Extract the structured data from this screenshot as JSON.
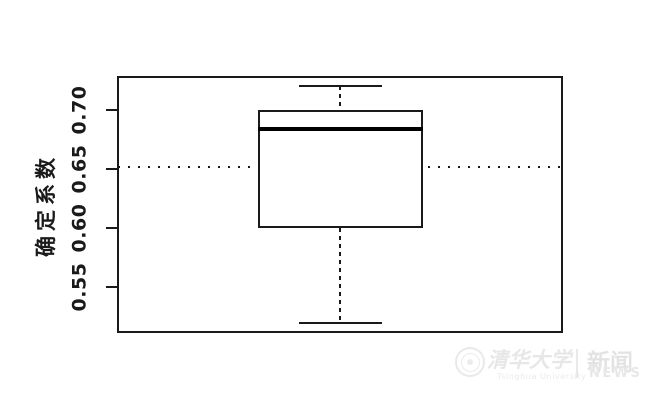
{
  "chart_data": {
    "type": "boxplot",
    "title": "",
    "xlabel": "",
    "ylabel": "确定系数",
    "ylim": [
      0.512,
      0.728
    ],
    "yticks": [
      0.55,
      0.6,
      0.65,
      0.7
    ],
    "ytick_labels": [
      "0.55",
      "0.60",
      "0.65",
      "0.70"
    ],
    "grid": false,
    "legend": false,
    "series": [
      {
        "name": "确定系数分布",
        "stats": {
          "whisker_low": 0.52,
          "q1": 0.6,
          "median": 0.684,
          "q3": 0.7,
          "whisker_high": 0.72
        }
      }
    ],
    "reference_line": {
      "value": 0.652,
      "style": "dotted"
    }
  },
  "watermark": {
    "logo": "tsinghua-university-seal",
    "cn_name": "清华大学",
    "en_name": "Tsinghua University",
    "channel_cn": "新闻",
    "channel_en": "NEWS"
  },
  "colors": {
    "line": "#1a1a1a",
    "background": "#ffffff",
    "watermark": "#e7e7e7"
  }
}
